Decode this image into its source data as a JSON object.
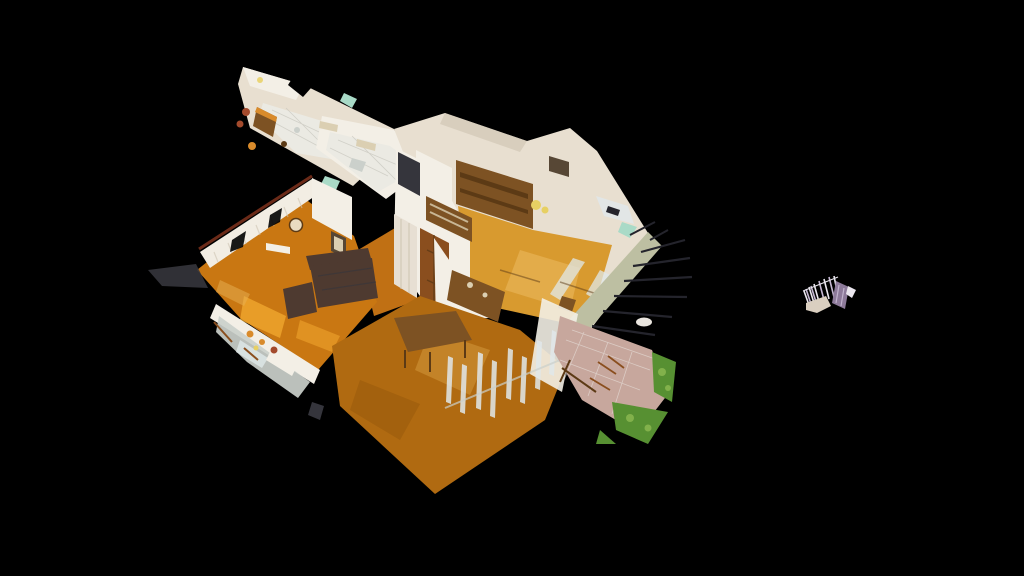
{
  "viewer": {
    "background_color": "#000000",
    "mode": "dollhouse-3d-view"
  },
  "scene": {
    "description": "Cutaway dollhouse view of a 3D-scanned apartment: kitchen wing with white tile floor, bathroom strip, attic living room with wall unit and sloped roof edge, parlor with lace curtains and leather sofa, hallway with doors, large herringbone-parquet dining room, pink-tiled terrace with greenery, exposed dark rafters, and a small detached scan fragment floating to the right",
    "model_regions": [
      "kitchen-wing",
      "bathroom",
      "attic-room",
      "living-room",
      "hallway",
      "dining-room",
      "terrace",
      "lower-level-cutaway",
      "scan-fragment"
    ]
  },
  "colors": {
    "background": "#000000",
    "wall_cream": "#e8dfd0",
    "wall_white": "#f3efe6",
    "wall_shadow": "#cdc3b1",
    "tile_white": "#ebeae3",
    "tile_grout": "#c6c5bc",
    "attic_floor": "#d89a2f",
    "attic_floor_light": "#e7b254",
    "living_floor": "#c97712",
    "living_floor_shine": "#f2a930",
    "big_floor": "#b06a11",
    "big_floor_dark": "#96570c",
    "hall_floor": "#c07014",
    "wood_cabinet": "#7d5223",
    "wood_dark": "#5c3a15",
    "door_brown": "#8a4e1e",
    "door_white": "#e7dfd3",
    "sofa_brown": "#4e3a30",
    "picture_frame": "#574735",
    "clock_face": "#eadcc0",
    "terrace_tile": "#c7a79d",
    "terrace_white": "#eae5df",
    "greenery": "#579032",
    "greenery_light": "#82b14b",
    "roof_band": "#bdbfa2",
    "rafter_dark": "#24242c",
    "mint": "#a9dac7",
    "radiator_beige": "#dbcfb2",
    "curtain_white": "#f2ede3",
    "curtain_rail": "#6b2a18",
    "glass_gray": "#cbd0cb",
    "window_streak": "#e0e8ea",
    "shadow_dark": "#35353c",
    "accent_orange": "#d98b2b",
    "clutter_red": "#a34a2c",
    "lamp_yellow": "#e7d063",
    "fragment_purple": "#8d7a9a",
    "fragment_lavender": "#c6b8d3",
    "fragment_white": "#ebe7ef",
    "fragment_beige": "#dacfc0"
  }
}
